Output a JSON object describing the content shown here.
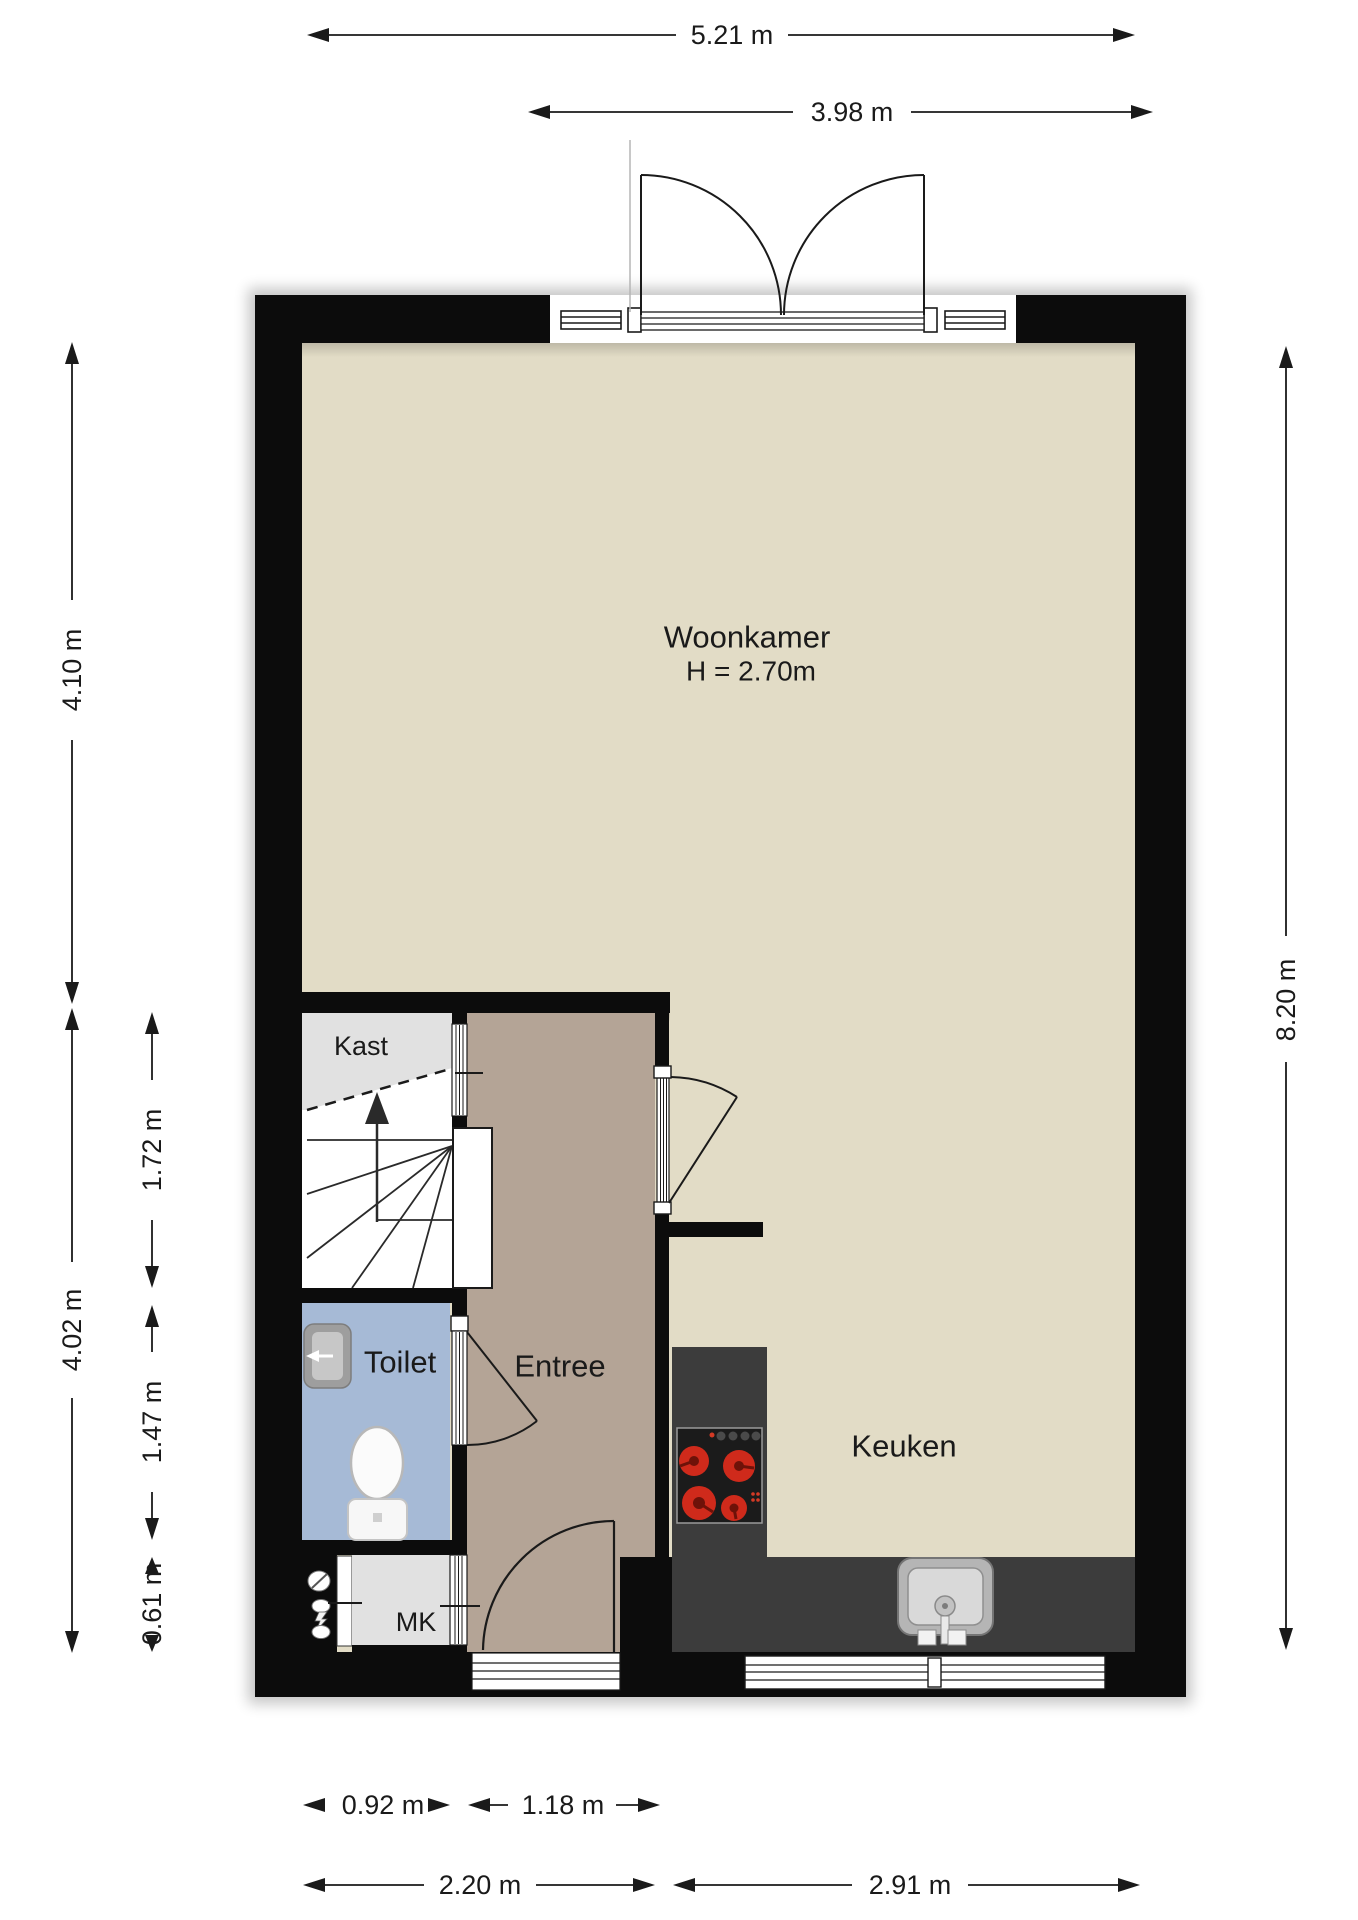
{
  "page": {
    "type": "floor-plan",
    "background": "#ffffff"
  },
  "rooms": {
    "woonkamer": {
      "label": "Woonkamer",
      "ceiling": "H = 2.70m"
    },
    "kast": {
      "label": "Kast"
    },
    "toilet": {
      "label": "Toilet"
    },
    "entree": {
      "label": "Entree"
    },
    "keuken": {
      "label": "Keuken"
    },
    "mk": {
      "label": "MK"
    }
  },
  "dimensions": {
    "top_total": "5.21 m",
    "top_doors": "3.98 m",
    "left_upper": "4.10 m",
    "left_lower": "4.02 m",
    "left_inner_stairs": "1.72 m",
    "left_inner_toilet": "1.47 m",
    "left_inner_mk": "0.61 m",
    "right_total": "8.20 m",
    "bottom_inner_left": "0.92 m",
    "bottom_inner_right": "1.18 m",
    "bottom_left": "2.20 m",
    "bottom_right": "2.91 m"
  },
  "colors": {
    "wall": "#0c0c0c",
    "floor_main": "#e2dcc6",
    "floor_entree": "#b4a496",
    "floor_closet": "#e1e1e1",
    "floor_toilet": "#a6bad6",
    "counter": "#3c3c3c",
    "stove": "#1b1b1b",
    "burner": "#cf2a1b"
  }
}
